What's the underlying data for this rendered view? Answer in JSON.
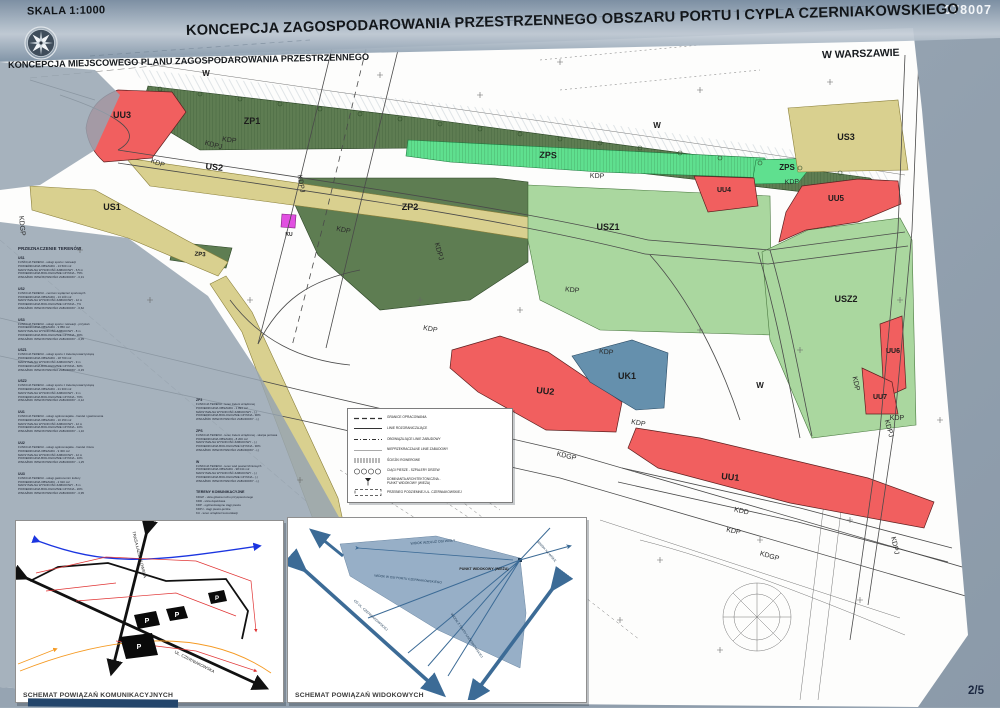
{
  "header": {
    "scale": "SKALA 1:1000",
    "sheet_no": "078007",
    "title": "KONCEPCJA ZAGOSPODAROWANIA PRZESTRZENNEGO OBSZARU PORTU I CYPLA CZERNIAKOWSKIEGO",
    "city": "W WARSZAWIE",
    "subtitle": "KONCEPCJA MIEJSCOWEGO PLANU ZAGOSPODAROWANIA PRZESTRZENNEGO",
    "page": "2/5",
    "compass_icon": "compass-rose-icon"
  },
  "colors": {
    "background": "#97a5b2",
    "banner_dark": "#7b8ea2",
    "banner_light": "#c3ccd6",
    "sheet": "#fdfdfc",
    "zone_red": "#f15f5f",
    "zone_dark_green": "#5e7d52",
    "zone_mint": "#5fe08f",
    "zone_light_green": "#aad79f",
    "zone_khaki": "#d9d08f",
    "zone_blue": "#6590ad",
    "zone_magenta": "#e14fe1",
    "navy_accent": "#23456b",
    "view_inset_blue": "#7e9cba"
  },
  "map": {
    "zone_labels": {
      "zp1": "ZP1",
      "zp2": "ZP2",
      "zp3": "ZP3",
      "zps": "ZPS",
      "us1": "US1",
      "us2": "US2",
      "us3": "US3",
      "usz1": "USZ1",
      "usz2": "USZ2",
      "uu1": "UU1",
      "uu2": "UU2",
      "uu3": "UU3",
      "uu4": "UU4",
      "uu5": "UU5",
      "uu6": "UU6",
      "uu7": "UU7",
      "uk1": "UK1",
      "ku": "KU",
      "w": "W"
    },
    "road_labels": {
      "kdp": "KDP",
      "kdpj": "KDPJ",
      "kdgp": "KDGP",
      "kdd": "KDD"
    }
  },
  "land_use": {
    "heading": "PRZEZNACZENIE TERENÓW",
    "col_a": [
      {
        "code": "US1",
        "lines": [
          "FUNKCJA TERENU - usługi sportu i rekreacji",
          "POWIERZCHNIA OBSZARU - 13 500 m2",
          "MAKSYMALNA WYSOKOŚĆ ZABUDOWY - 6,5 m",
          "POWIERZCHNIA BIOLOGICZNIE CZYNNA - 75%",
          "WSKAŹNIK INTENSYWNOŚCI ZABUDOWY - 0,31"
        ]
      },
      {
        "code": "US2",
        "lines": [
          "FUNKCJA TERENU - centrum wydarzeń sportowych",
          "POWIERZCHNIA OBSZARU - 13 100 m2",
          "MAKSYMALNA WYSOKOŚĆ ZABUDOWY - 12 m",
          "POWIERZCHNIA BIOLOGICZNIE CZYNNA - 7%",
          "WSKAŹNIK INTENSYWNOŚCI ZABUDOWY - 0,62"
        ]
      },
      {
        "code": "US3",
        "lines": [
          "FUNKCJA TERENU - usługi sportu i rekreacji - przystań",
          "POWIERZCHNIA OBSZARU - 9 850 m2",
          "MAKSYMALNA WYSOKOŚĆ ZABUDOWY - 8 m",
          "POWIERZCHNIA BIOLOGICZNIE CZYNNA - 30%",
          "WSKAŹNIK INTENSYWNOŚCI ZABUDOWY - 0,35"
        ]
      },
      {
        "code": "USZ1",
        "lines": [
          "FUNKCJA TERENU - usługi sportu z zielenią towarzyszącą",
          "POWIERZCHNIA OBSZARU - 18 700 m2",
          "MAKSYMALNA WYSOKOŚĆ ZABUDOWY - 9 m",
          "POWIERZCHNIA BIOLOGICZNIE CZYNNA - 60%",
          "WSKAŹNIK INTENSYWNOŚCI ZABUDOWY - 0,15"
        ]
      },
      {
        "code": "USZ2",
        "lines": [
          "FUNKCJA TERENU - usługi sportu z zielenią towarzyszącą",
          "POWIERZCHNIA OBSZARU - 21 300 m2",
          "MAKSYMALNA WYSOKOŚĆ ZABUDOWY - 9 m",
          "POWIERZCHNIA BIOLOGICZNIE CZYNNA - 70%",
          "WSKAŹNIK INTENSYWNOŚCI ZABUDOWY - 0,12"
        ]
      },
      {
        "code": "UU1",
        "lines": [
          "FUNKCJA TERENU - usługi ogólnomiejskie - handel i gastronomia",
          "POWIERZCHNIA OBSZARU - 10 150 m2",
          "MAKSYMALNA WYSOKOŚĆ ZABUDOWY - 12 m",
          "POWIERZCHNIA BIOLOGICZNIE CZYNNA - 10%",
          "WSKAŹNIK INTENSYWNOŚCI ZABUDOWY - 1,10"
        ]
      },
      {
        "code": "UU2",
        "lines": [
          "FUNKCJA TERENU - usługi ogólnomiejskie - handel i biura",
          "POWIERZCHNIA OBSZARU - 9 300 m2",
          "MAKSYMALNA WYSOKOŚĆ ZABUDOWY - 12 m",
          "POWIERZCHNIA BIOLOGICZNIE CZYNNA - 10%",
          "WSKAŹNIK INTENSYWNOŚCI ZABUDOWY - 1,25"
        ]
      },
      {
        "code": "UU3",
        "lines": [
          "FUNKCJA TERENU - usługi gastronomii i kultury",
          "POWIERZCHNIA OBSZARU - 2 910 m2",
          "MAKSYMALNA WYSOKOŚĆ ZABUDOWY - 8 m",
          "POWIERZCHNIA BIOLOGICZNIE CZYNNA - 20%",
          "WSKAŹNIK INTENSYWNOŚCI ZABUDOWY - 0,95"
        ]
      }
    ],
    "col_b": [
      {
        "code": "ZP3",
        "lines": [
          "FUNKCJA TERENU - teren zieleni urządzonej",
          "POWIERZCHNIA OBSZARU - 1 894 m2",
          "MAKSYMALNA WYSOKOŚĆ ZABUDOWY - (-)",
          "POWIERZCHNIA BIOLOGICZNIE CZYNNA - 90%",
          "WSKAŹNIK INTENSYWNOŚCI ZABUDOWY - (-)"
        ]
      },
      {
        "code": "ZPS",
        "lines": [
          "FUNKCJA TERENU - teren zieleni urządzonej - skarpa portowa",
          "POWIERZCHNIA OBSZARU - 8 200 m2",
          "MAKSYMALNA WYSOKOŚĆ ZABUDOWY - (-)",
          "POWIERZCHNIA BIOLOGICZNIE CZYNNA - 90%",
          "WSKAŹNIK INTENSYWNOŚCI ZABUDOWY - (-)"
        ]
      },
      {
        "code": "W",
        "lines": [
          "FUNKCJA TERENU - teren wód powierzchniowych",
          "POWIERZCHNIA OBSZARU - 98 044 m2",
          "MAKSYMALNA WYSOKOŚĆ ZABUDOWY - (-)",
          "POWIERZCHNIA BIOLOGICZNIE CZYNNA - (-)",
          "WSKAŹNIK INTENSYWNOŚCI ZABUDOWY - (-)"
        ]
      }
    ],
    "transport": {
      "heading": "TERENY KOMUNIKACYJNE",
      "items": [
        "KDGP - ulica główna ruchu przyspieszonego",
        "KDD - ulica dojazdowa",
        "KDP - ogólnodostępne ciągi piesze",
        "KDPJ - ciągi pieszo-jezdne",
        "KU - teren urządzeń komunikacji"
      ]
    }
  },
  "legend": {
    "rows": [
      {
        "symbol": "dash",
        "label": "GRANICE OPRACOWANIA"
      },
      {
        "symbol": "solid",
        "label": "LINIE ROZGRANICZAJĄCE"
      },
      {
        "symbol": "dashdot",
        "label": "OBOWIĄZUJĄCE LINIE ZABUDOWY"
      },
      {
        "symbol": "thin",
        "label": "NIEPRZEKRACZALNE LINIE ZABUDOWY"
      },
      {
        "symbol": "ticks",
        "label": "ŚCIEŻKI ROWEROWE"
      },
      {
        "symbol": "circles",
        "label": "CIĄGI PIESZE - SZPALERY DRZEW"
      },
      {
        "symbol": "viewpoint",
        "label": "DOMINANTA ARCHITEKTONICZNA -",
        "label2": "PUNKT WIDOKOWY (WIEŻA)"
      },
      {
        "symbol": "dashedbox",
        "label": "PRZEBIEG PODZIEMNEJ UL. CZERNIAKOWSKIEJ"
      }
    ]
  },
  "insets": {
    "transport": {
      "caption": "SCHEMAT POWIĄZAŃ KOMUNIKACYJNYCH",
      "labels": {
        "trasa": "TRASA ŁAZIENKOWSKA",
        "czerniakowska": "UL. CZERNIAKOWSKA",
        "parking": "P"
      }
    },
    "views": {
      "caption": "SCHEMAT POWIĄZAŃ WIDOKOWYCH",
      "labels": {
        "wisla_axis": "WIDOK WZDŁUŻ OSI WISŁY",
        "viewpoint": "PUNKT WIDOKOWY (WIEŻA)",
        "port_axis": "WIDOK W OSI PORTU CZERNIAKOWSKIEGO",
        "czerniakowska_axis": "OŚ UL. CZERNIAKOWSKIEJ",
        "lazienkowska_axis": "WIDOK Z TRASY ŁAZIENKOWSKIEJ",
        "wisla_view": "WIDOK NA WISŁĘ"
      }
    }
  }
}
